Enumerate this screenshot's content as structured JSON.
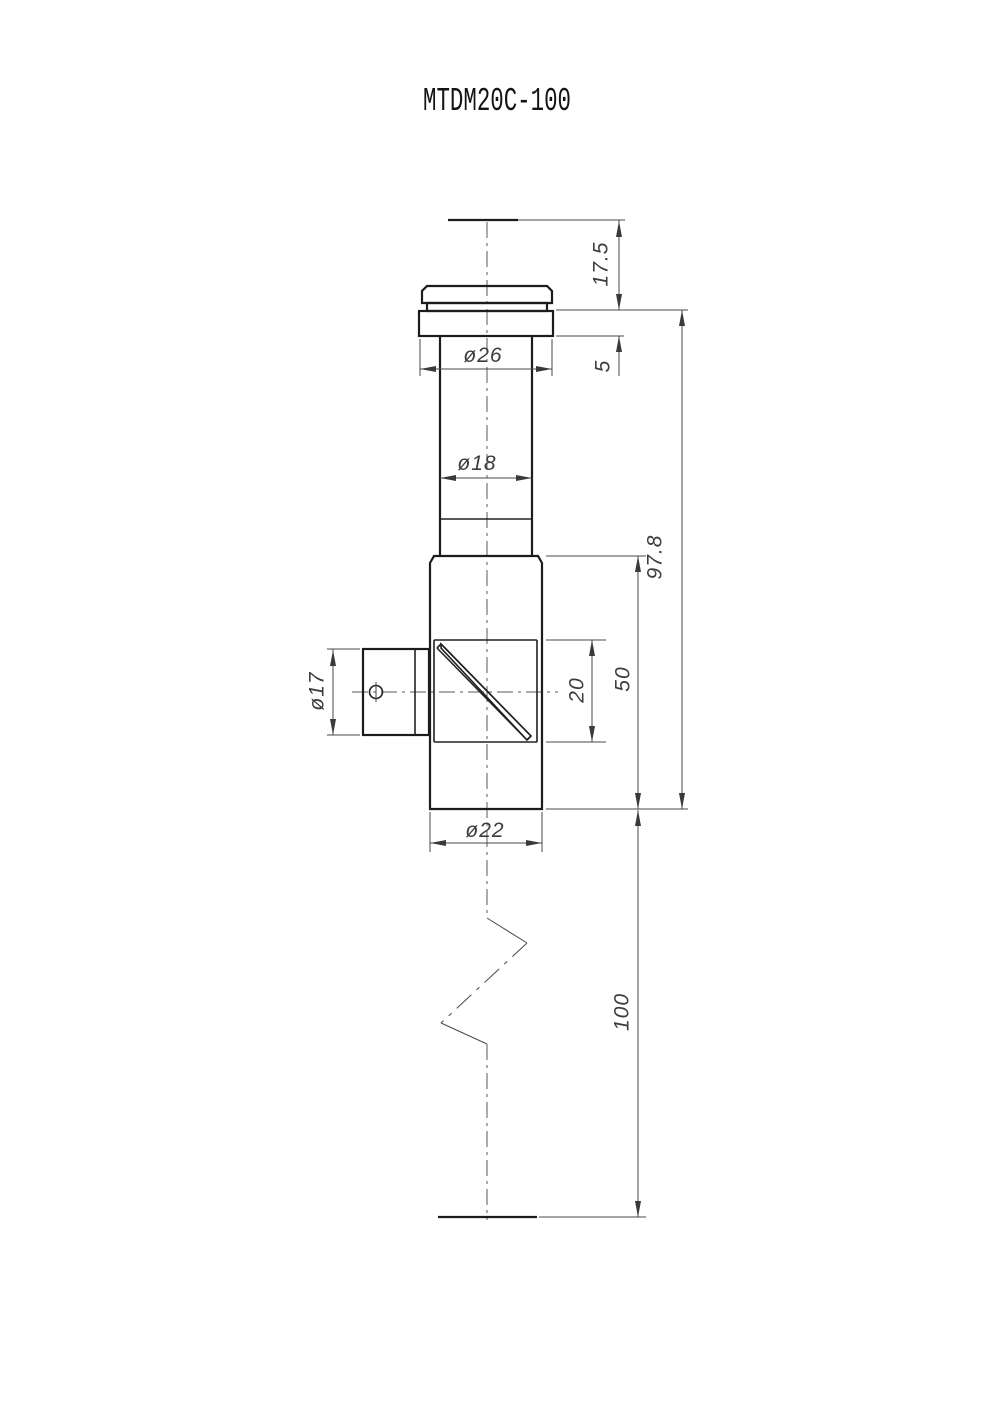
{
  "title": "MTDM20C-100",
  "drawing": {
    "type": "mechanical-dimension-drawing",
    "part_number": "MTDM20C-100",
    "dimensions": {
      "top_offset": "17.5",
      "flange_thickness": "5",
      "flange_diameter": "ø26",
      "tube_diameter": "ø18",
      "flange_to_bottom": "97.8",
      "body_length": "50",
      "prism_section_length": "20",
      "side_port_diameter": "ø17",
      "body_diameter": "ø22",
      "lower_extension_length": "100"
    },
    "colors": {
      "background": "#ffffff",
      "part_edge": "#1c1c1c",
      "dimension_line": "#4a4a4a",
      "dimension_text": "#3d3d3d"
    }
  }
}
